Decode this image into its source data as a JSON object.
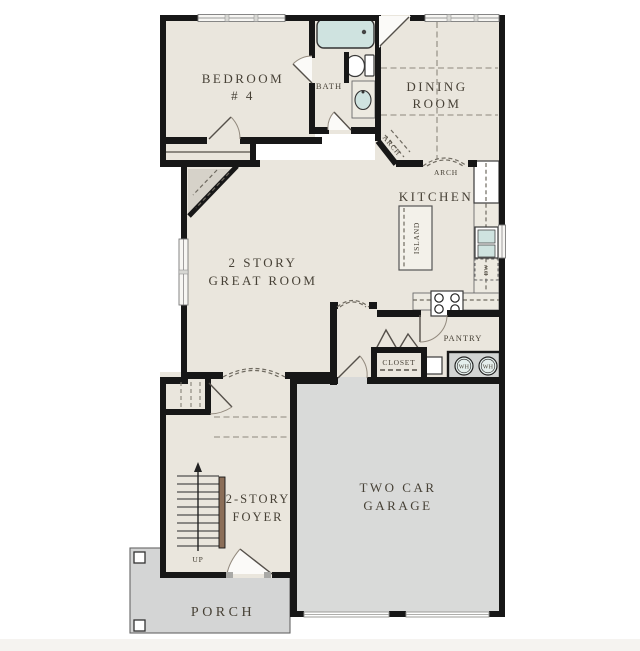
{
  "labels": {
    "bedroom_line1": "BEDROOM",
    "bedroom_line2": "# 4",
    "bath": "BATH",
    "dining_line1": "DINING",
    "dining_line2": "ROOM",
    "arch_diagonal": "ARCH",
    "arch_dining": "ARCH",
    "kitchen": "KITCHEN",
    "island": "ISLAND",
    "dishwasher": "DW",
    "great_room_line1": "2 STORY",
    "great_room_line2": "GREAT ROOM",
    "pantry": "PANTRY",
    "closet": "CLOSET",
    "water_heater_1": "WH",
    "water_heater_2": "WH",
    "garage_line1": "TWO CAR",
    "garage_line2": "GARAGE",
    "stairs_direction": "UP",
    "foyer_line1": "2-STORY",
    "foyer_line2": "FOYER",
    "porch": "PORCH"
  },
  "colors": {
    "floor_beige": "#eae6dd",
    "garage_gray": "#d9dad9",
    "porch_gray": "#d4d5d5",
    "wall_black": "#171717",
    "fixture_teal": "#cfe3e0",
    "stair_rail_brown": "#8b6e58",
    "label_text": "#474136",
    "shaded_corner": "#d6d2c9"
  }
}
